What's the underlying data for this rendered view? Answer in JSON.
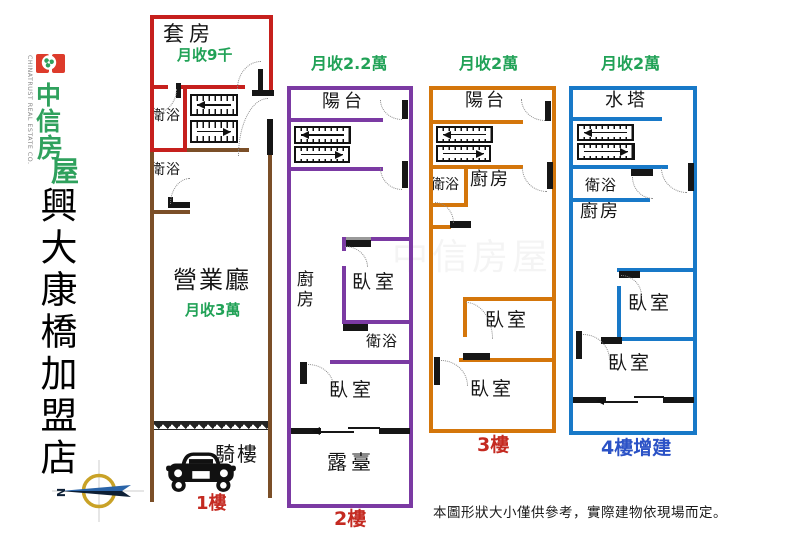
{
  "brand": {
    "emblem_icon": "chinatrust-flower-icon",
    "name_vertical": "中信房屋",
    "chars": [
      "中",
      "信",
      "房",
      "屋"
    ],
    "english": "CHINATRUST REAL ESTATE CO.",
    "color_red": "#DD3B2B",
    "color_green": "#2FA15D"
  },
  "store_name": "興大康橋加盟店",
  "compass": {
    "north_label": "N"
  },
  "watermark": "中信房屋",
  "disclaimer": "本圖形狀大小僅供參考，實際建物依現場而定。",
  "colors": {
    "floor1_upper_outline": "#C6201D",
    "floor1_lower_outline": "#7B4F28",
    "floor2_outline": "#7B3AA3",
    "floor3_outline": "#D4760B",
    "floor4_outline": "#1879C8",
    "rent_text_green": "#21A257",
    "floor_label_red": "#C42A21",
    "floor_label_blue": "#2B52C6"
  },
  "floors": [
    {
      "label": "1樓",
      "suite": "套房",
      "suite_rent": "月收9千",
      "bath_upper": "衛浴",
      "bath_lower": "衛浴",
      "hall": "營業廳",
      "hall_rent": "月收3萬",
      "arcade": "騎樓"
    },
    {
      "label": "2樓",
      "rent": "月收2.2萬",
      "balcony": "陽台",
      "kitchen": "廚房",
      "bedroom1": "臥室",
      "bath": "衛浴",
      "bedroom2": "臥室",
      "terrace": "露臺"
    },
    {
      "label": "3樓",
      "rent": "月收2萬",
      "balcony": "陽台",
      "bath": "衛浴",
      "kitchen": "廚房",
      "bedroom1": "臥室",
      "bedroom2": "臥室"
    },
    {
      "label": "4樓增建",
      "rent": "月收2萬",
      "tank": "水塔",
      "bath": "衛浴",
      "kitchen": "廚房",
      "bedroom1": "臥室",
      "bedroom2": "臥室"
    }
  ]
}
